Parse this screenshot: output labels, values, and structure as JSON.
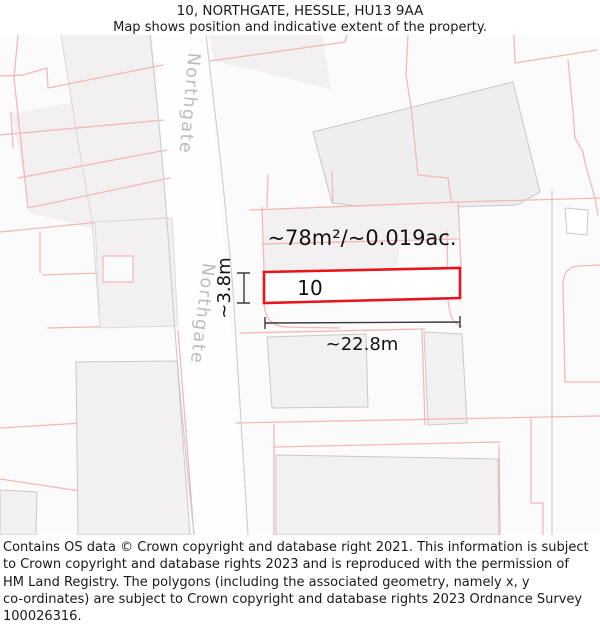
{
  "header": {
    "title": "10, NORTHGATE, HESSLE, HU13 9AA",
    "subtitle": "Map shows position and indicative extent of the property."
  },
  "map": {
    "street_label_upper": "Northgate",
    "street_label_lower": "Northgate",
    "property": {
      "number": "10",
      "area_label": "~78m²/~0.019ac.",
      "width_label": "~22.8m",
      "depth_label": "~3.8m"
    },
    "colors": {
      "plot_outline": "#e8141b",
      "parcel_line": "#f4b8b6",
      "building_fill": "#f2f0f0",
      "building_edge": "#c9c9c9",
      "street_text": "#bcbcbc",
      "measure_line": "#3a3a3a"
    }
  },
  "footer": {
    "lines": [
      "Contains OS data © Crown copyright and database right 2021. This information is subject",
      "to Crown copyright and database rights 2023 and is reproduced with the permission of",
      "HM Land Registry. The polygons (including the associated geometry, namely x, y",
      "co-ordinates) are subject to Crown copyright and database rights 2023 Ordnance Survey",
      "100026316."
    ]
  }
}
